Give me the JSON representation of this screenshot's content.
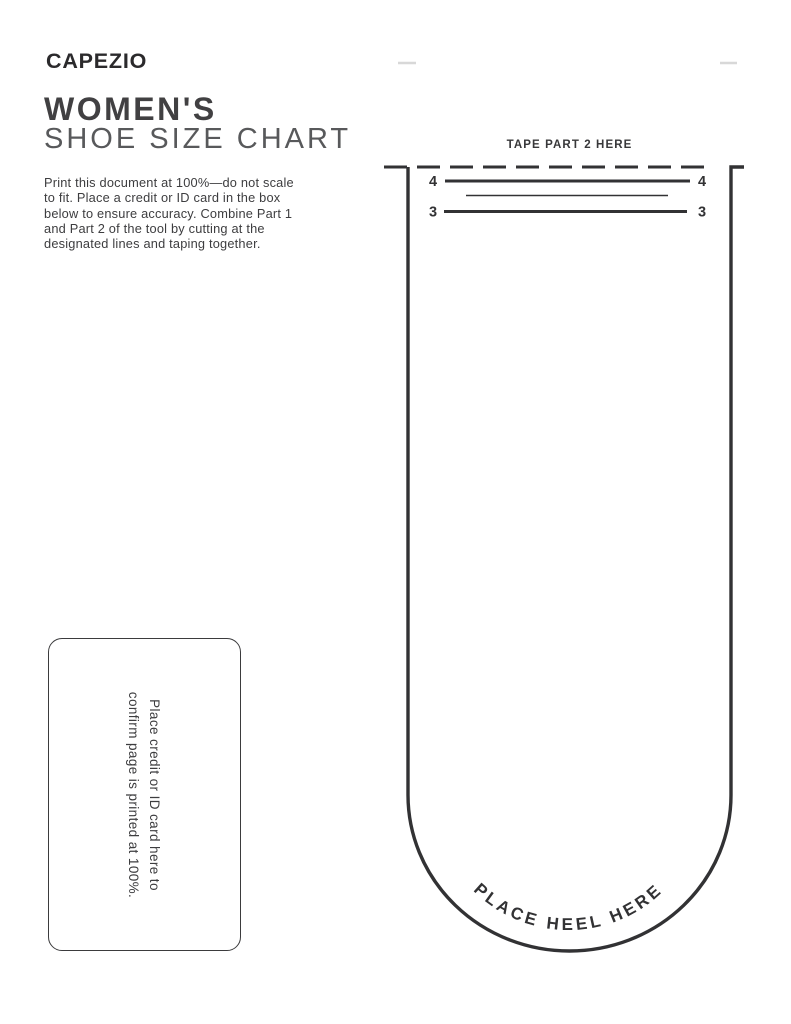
{
  "brand": {
    "logo": "CAPEZIO"
  },
  "header": {
    "title_bold": "WOMEN'S",
    "title_light": "SHOE SIZE CHART"
  },
  "instructions": {
    "lines": [
      "Print this document at 100%—do not scale",
      "to fit. Place a credit or ID card in the box",
      "below to ensure accuracy. Combine Part 1",
      "and Part 2 of the tool by cutting at the",
      "designated lines and taping together."
    ]
  },
  "card_box": {
    "line1": "Place credit or ID card here to",
    "line2": "confirm page is printed at 100%."
  },
  "measuring_tool": {
    "tape_label": "TAPE PART 2 HERE",
    "heel_label": "PLACE HEEL HERE",
    "size_marks": {
      "upper": "4",
      "lower": "3"
    }
  },
  "colors": {
    "ink": "#323234",
    "heading_light": "#58595b",
    "faint_mark": "#d8d8d8"
  }
}
